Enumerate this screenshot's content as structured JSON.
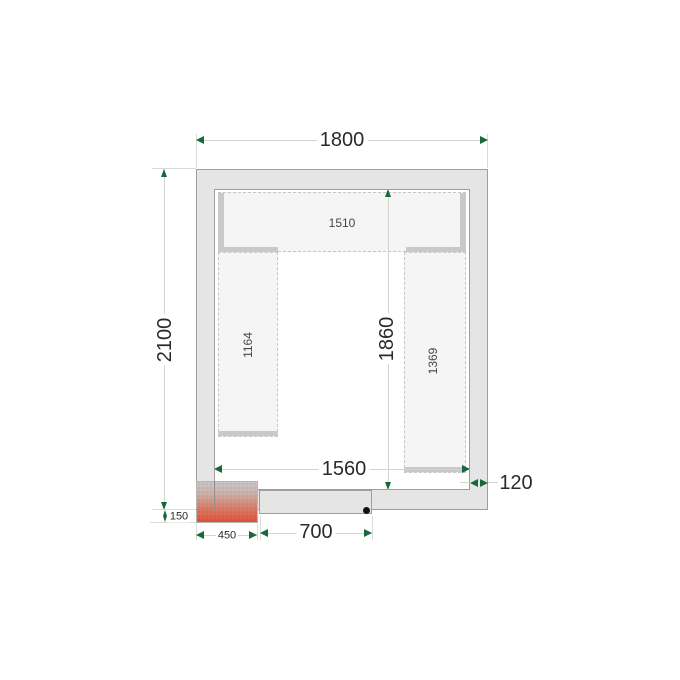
{
  "drawing": {
    "title": "cold-room-floor-plan",
    "labels": {
      "width_1800": "1800",
      "height_2100": "2100",
      "inner_1860": "1860",
      "inner_1560": "1560",
      "wall_120": "120",
      "unit_150": "150",
      "unit_450": "450",
      "door_700": "700",
      "shelf_top_1510": "1510",
      "shelf_left_1164": "1164",
      "shelf_right_1369": "1369"
    },
    "colors": {
      "wall_fill": "#e5e5e5",
      "wall_line": "#9e9e9e",
      "shelf_fill": "#f5f5f5",
      "shelf_bar": "#c9c9c9",
      "dimension_arrow_green": "#17693c",
      "cooling_unit_red": "#e2503c",
      "text": "#2a2a2a"
    }
  }
}
